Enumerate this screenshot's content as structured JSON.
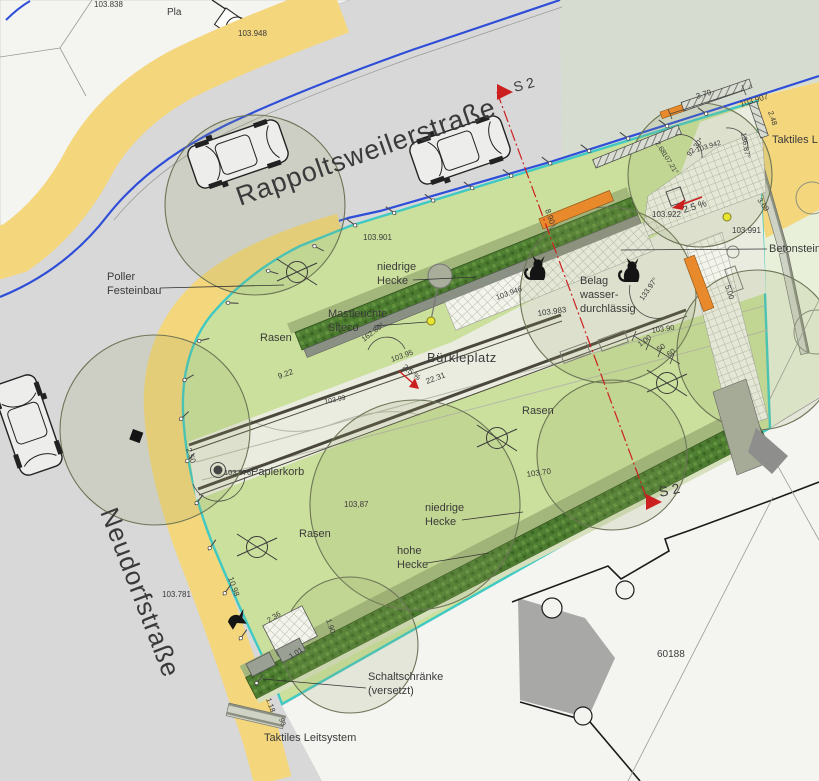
{
  "plan_type": "landscape site plan",
  "streets": {
    "top": "Rappoltsweilerstraße",
    "left": "Neudorfstraße"
  },
  "place_name": "Bürkleplatz",
  "parcel_number": "60188",
  "parcel_partial": "Pla",
  "section_marker": "S 2",
  "lawn_label": "Rasen",
  "colors": {
    "street": "#d8d8d8",
    "pale": "#d6dccf",
    "white": "#f4f4f1",
    "lawn": "#cbe09c",
    "paved": "#eaece0",
    "yellow": "#f4d67c",
    "blue": "#2f4ed8",
    "cyan": "#3fc9c3",
    "orange": "#e8892b",
    "olive": "#a3b77d",
    "hedge": "#4c7c30",
    "red": "#cc2020"
  },
  "annotations": [
    {
      "n": "elev-103838",
      "t": "103.838",
      "x": 94,
      "y": 7,
      "s": 8
    },
    {
      "n": "elev-103948",
      "t": "103.948",
      "x": 238,
      "y": 36,
      "s": 8
    },
    {
      "n": "elev-103901",
      "t": "103.901",
      "x": 363,
      "y": 240,
      "s": 8
    },
    {
      "n": "label-poller-line1",
      "t": "Poller",
      "x": 107,
      "y": 280,
      "s": 11
    },
    {
      "n": "label-poller-line2",
      "t": "Festeinbau",
      "x": 107,
      "y": 294,
      "s": 11
    },
    {
      "n": "label-hecke-top-line1",
      "t": "niedrige",
      "x": 377,
      "y": 270,
      "s": 11
    },
    {
      "n": "label-hecke-top-line2",
      "t": "Hecke",
      "x": 377,
      "y": 284,
      "s": 11
    },
    {
      "n": "label-mastleuchte-line1",
      "t": "Mastleuchte",
      "x": 328,
      "y": 317,
      "s": 11
    },
    {
      "n": "label-mastleuchte-line2",
      "t": "Siteco",
      "x": 328,
      "y": 331,
      "s": 11
    },
    {
      "n": "label-belag-line1",
      "t": "Belag",
      "x": 580,
      "y": 284,
      "s": 11
    },
    {
      "n": "label-belag-line2",
      "t": "wasser-",
      "x": 580,
      "y": 298,
      "s": 11
    },
    {
      "n": "label-belag-line3",
      "t": "durchlässig",
      "x": 580,
      "y": 312,
      "s": 11
    },
    {
      "n": "elev-103946",
      "t": "103.946",
      "x": 497,
      "y": 300,
      "r": -20,
      "s": 7.5
    },
    {
      "n": "elev-103983",
      "t": "103.983",
      "x": 538,
      "y": 316,
      "r": -8,
      "s": 8
    },
    {
      "n": "elev-103922",
      "t": "103.922",
      "x": 652,
      "y": 217,
      "s": 8
    },
    {
      "n": "elev-103907",
      "t": "103.907",
      "x": 741,
      "y": 107,
      "r": -17,
      "s": 8
    },
    {
      "n": "elev-103942",
      "t": "103.942",
      "x": 697,
      "y": 152,
      "r": -17,
      "s": 7,
      "c": "#8b8b85"
    },
    {
      "n": "elev-103991",
      "t": "103.991",
      "x": 732,
      "y": 233,
      "s": 8
    },
    {
      "n": "elev-10395",
      "t": "103.95",
      "x": 392,
      "y": 362,
      "r": -20,
      "s": 7.5
    },
    {
      "n": "elev-10370",
      "t": "103.70",
      "x": 527,
      "y": 477,
      "r": -8,
      "s": 8
    },
    {
      "n": "elev-10387",
      "t": "103,87",
      "x": 344,
      "y": 507,
      "s": 8
    },
    {
      "n": "elev-103781",
      "t": "103.781",
      "x": 162,
      "y": 597,
      "s": 8
    },
    {
      "n": "elev-103976",
      "t": "103.976",
      "x": 224,
      "y": 475,
      "s": 7.5
    },
    {
      "n": "label-papierkorb",
      "t": "Papierkorb",
      "x": 251,
      "y": 475,
      "s": 11
    },
    {
      "n": "dim-2231",
      "t": "22.31",
      "x": 427,
      "y": 384,
      "r": -20,
      "s": 8
    },
    {
      "n": "dim-922",
      "t": "9.22",
      "x": 279,
      "y": 379,
      "r": -20,
      "s": 8
    },
    {
      "n": "dim-890",
      "t": "8.90",
      "x": 545,
      "y": 210,
      "r": 71,
      "s": 8
    },
    {
      "n": "dim-379",
      "t": "3.79",
      "x": 697,
      "y": 99,
      "r": -17,
      "s": 8
    },
    {
      "n": "dim-248",
      "t": "2.48",
      "x": 768,
      "y": 112,
      "r": 71,
      "s": 7.5
    },
    {
      "n": "ang-9230",
      "t": "92.30°",
      "x": 690,
      "y": 157,
      "r": -50,
      "s": 7.5
    },
    {
      "n": "dim-268",
      "t": "2.68",
      "x": 655,
      "y": 143,
      "r": 58,
      "s": 7
    },
    {
      "n": "ang-10721",
      "t": "107.21°",
      "x": 662,
      "y": 154,
      "r": 58,
      "s": 7
    },
    {
      "n": "ang-13687",
      "t": "136.87°",
      "x": 741,
      "y": 133,
      "r": 80,
      "s": 7.5
    },
    {
      "n": "dim-369",
      "t": "3.69",
      "x": 757,
      "y": 200,
      "r": 55,
      "s": 7.5
    },
    {
      "n": "dim-100",
      "t": "1.00",
      "x": 640,
      "y": 347,
      "r": -35,
      "s": 7.5
    },
    {
      "n": "dim-50",
      "t": "50",
      "x": 659,
      "y": 352,
      "r": -35,
      "s": 7.5
    },
    {
      "n": "dim-60",
      "t": "60",
      "x": 669,
      "y": 357,
      "r": -35,
      "s": 7.5
    },
    {
      "n": "dim-500",
      "t": "5.00",
      "x": 725,
      "y": 286,
      "r": 72,
      "s": 7.5
    },
    {
      "n": "ang-13397",
      "t": "133.97°",
      "x": 643,
      "y": 301,
      "r": -55,
      "s": 7.5
    },
    {
      "n": "elev-10390",
      "t": "103.90",
      "x": 652,
      "y": 333,
      "r": -8,
      "s": 7.5,
      "c": "#8b8b85"
    },
    {
      "n": "ang-16286",
      "t": "162.86°",
      "x": 364,
      "y": 342,
      "r": -38,
      "s": 7.5
    },
    {
      "n": "dim-250",
      "t": "2.50",
      "x": 186,
      "y": 449,
      "r": 71,
      "s": 8
    },
    {
      "n": "dim-1098",
      "t": "10.98",
      "x": 228,
      "y": 578,
      "r": 71,
      "s": 8
    },
    {
      "n": "dim-236",
      "t": "2.36",
      "x": 269,
      "y": 623,
      "r": -33,
      "s": 7.5
    },
    {
      "n": "dim-190",
      "t": "1.90",
      "x": 326,
      "y": 620,
      "r": 71,
      "s": 7.5
    },
    {
      "n": "dim-101",
      "t": "1.01",
      "x": 291,
      "y": 659,
      "r": -33,
      "s": 7.5
    },
    {
      "n": "dim-118",
      "t": "1.18",
      "x": 266,
      "y": 699,
      "r": 71,
      "s": 7.5
    },
    {
      "n": "dim-90",
      "t": "90",
      "x": 279,
      "y": 719,
      "r": 71,
      "s": 7
    },
    {
      "n": "label-hecke-bottom-line1",
      "t": "niedrige",
      "x": 425,
      "y": 511,
      "s": 11
    },
    {
      "n": "label-hecke-bottom-line2",
      "t": "Hecke",
      "x": 425,
      "y": 525,
      "s": 11
    },
    {
      "n": "label-hohe-hecke-line1",
      "t": "hohe",
      "x": 397,
      "y": 554,
      "s": 11
    },
    {
      "n": "label-hohe-hecke-line2",
      "t": "Hecke",
      "x": 397,
      "y": 568,
      "s": 11
    },
    {
      "n": "label-schaltschraenke-line1",
      "t": "Schaltschränke",
      "x": 368,
      "y": 680,
      "s": 11
    },
    {
      "n": "label-schaltschraenke-line2",
      "t": "(versetzt)",
      "x": 368,
      "y": 694,
      "s": 11
    },
    {
      "n": "label-taktiles-bottom",
      "t": "Taktiles Leitsystem",
      "x": 264,
      "y": 741,
      "s": 11
    },
    {
      "n": "label-taktiles-right",
      "t": "Taktiles L",
      "x": 772,
      "y": 143,
      "s": 11
    },
    {
      "n": "label-betonstein-right",
      "t": "Betonsteinp",
      "x": 769,
      "y": 252,
      "s": 11
    },
    {
      "n": "slope-arrow-label-1",
      "t": "2.5 %",
      "x": 684,
      "y": 213,
      "r": -17,
      "s": 9.5,
      "c": "#c22020"
    },
    {
      "n": "slope-arrow-label-2",
      "t": "2.5 %",
      "x": 402,
      "y": 368,
      "r": 38,
      "s": 8,
      "c": "#c22020"
    },
    {
      "n": "contour-label-10399",
      "t": "103.99",
      "x": 325,
      "y": 404,
      "r": -12,
      "s": 7,
      "c": "#8b8b85"
    }
  ]
}
